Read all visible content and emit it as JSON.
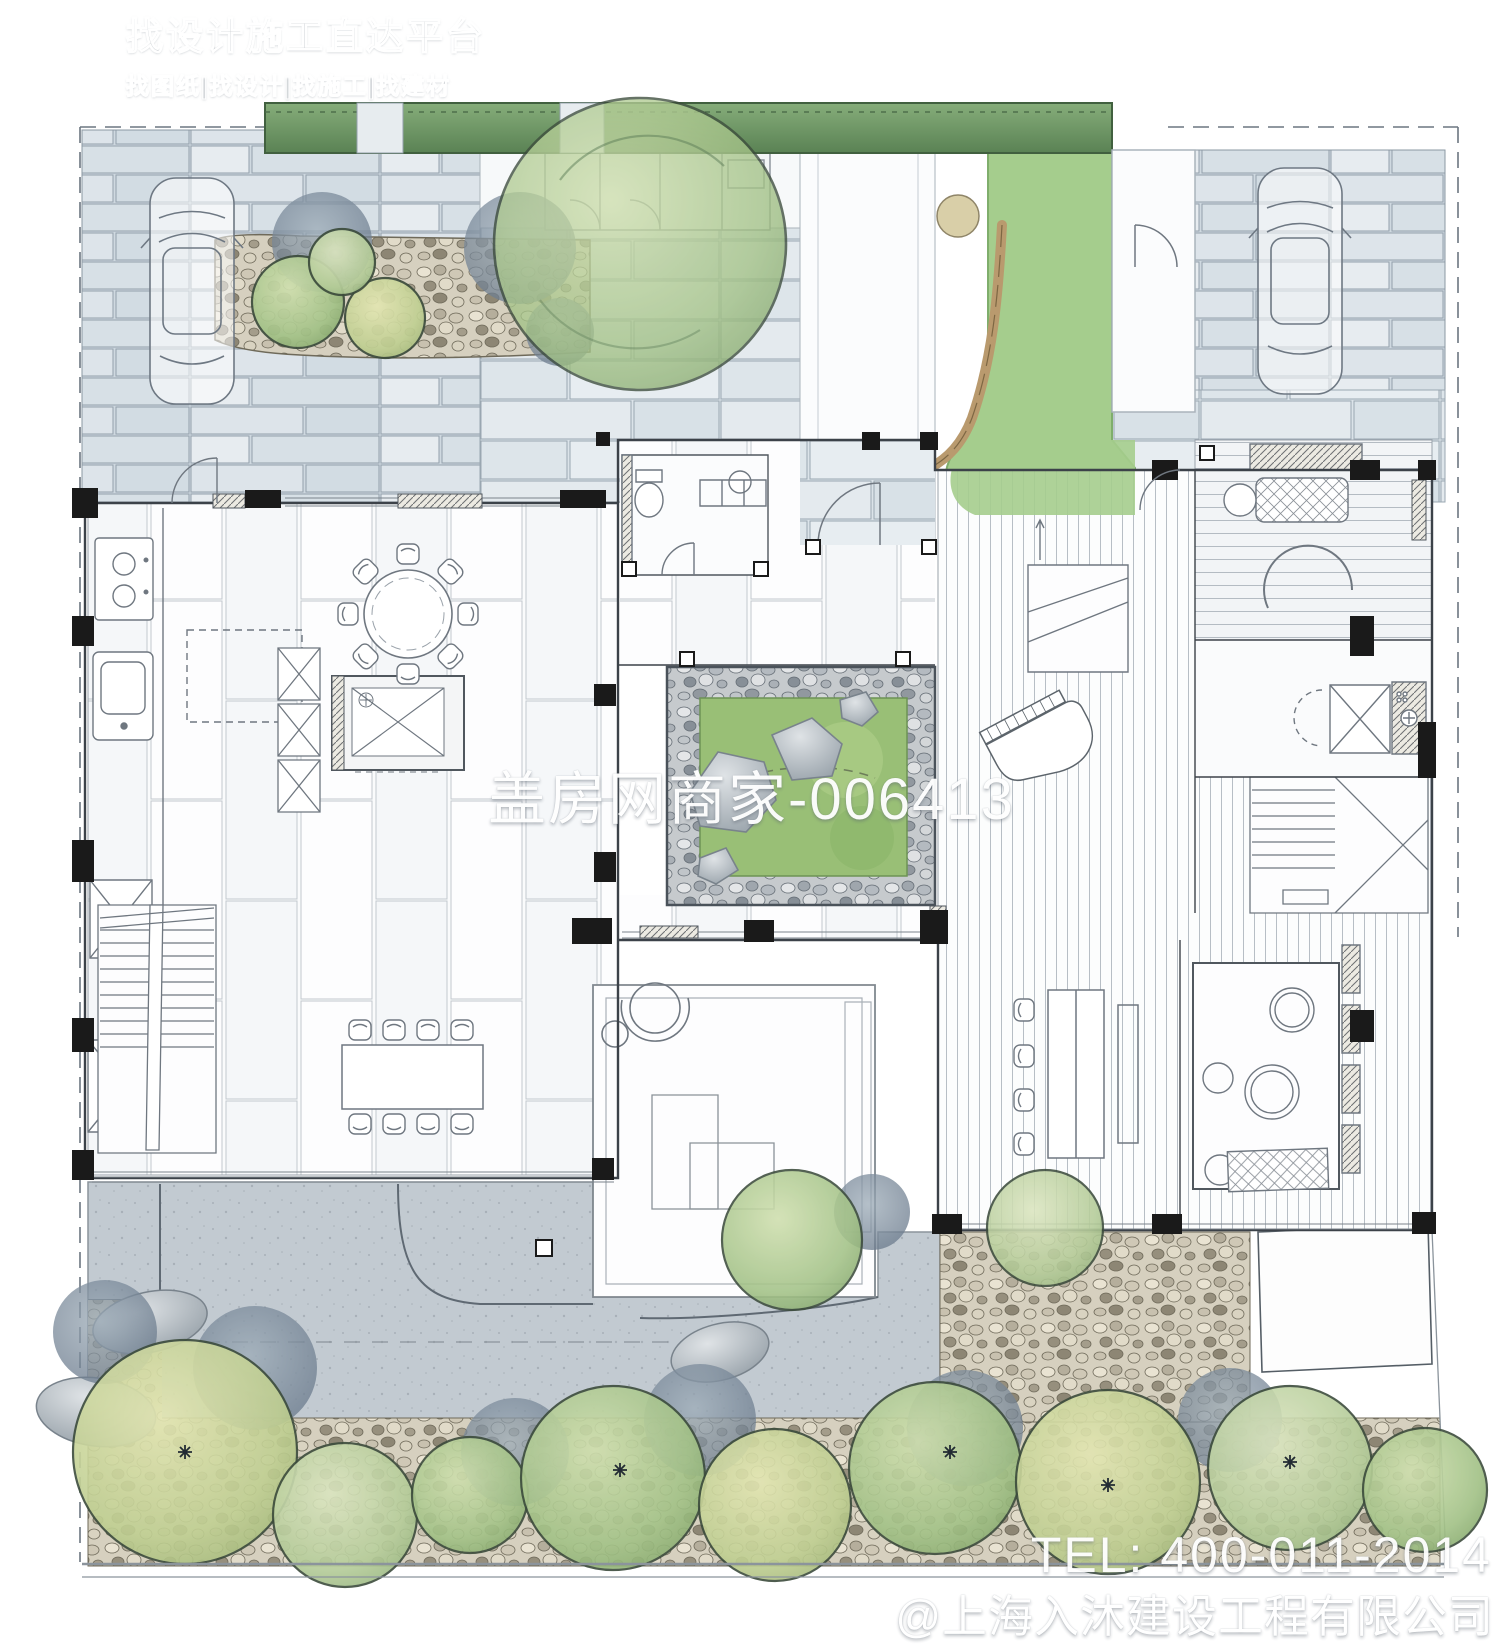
{
  "branding": {
    "logo_icon": "house-logo-icon",
    "title": "找设计施工直达平台",
    "subtitle": "找图纸|找设计|找施工|找建材"
  },
  "watermarks": {
    "center": "盖房网商家-006413",
    "phone": "TEL: 400-011-2014",
    "company": "@上海入沐建设工程有限公司"
  },
  "colors": {
    "paper": "#ffffff",
    "stone_paving": "#d5dee5",
    "stone_joint": "#93a0ab",
    "slab_light": "#e0e7ec",
    "concrete_plaza": "#c2cad1",
    "hedge_green": "#6f9a67",
    "hedge_dark": "#41603f",
    "lawn_green": "#a5cd8d",
    "curb_tan": "#b99a6e",
    "tree_green": "#9fc185",
    "tree_yellow": "#ccd89d",
    "tree_pale": "#bcd3a4",
    "shadow_slate": "#77889a",
    "pebble_sand": "#d6d0bf",
    "pebble_gray": "#c6cacd",
    "moss_green": "#99bf76",
    "rock_gray": "#b9c1c7",
    "ink_line": "#3c4249",
    "wall_black": "#1a1a1a",
    "floor_line": "#b7bec5",
    "text_white": "#ffffff"
  },
  "plan_features": [
    "site-boundary",
    "driveway-car",
    "second-car",
    "top-hedge",
    "shrub-bed",
    "entry-gatehouse",
    "large-tree-canopy",
    "lawn-strip",
    "stone-curb",
    "entry-walkway",
    "kitchen",
    "round-dining-table",
    "long-dining-table",
    "left-staircase",
    "powder-room",
    "inner-courtyard",
    "grand-piano",
    "deck-staircase",
    "tatami-room",
    "shower-room",
    "right-staircase",
    "tea-table",
    "bath-room",
    "sunken-living-platform",
    "hanging-chair",
    "terrace-plaza",
    "garden-trees",
    "white-terrace"
  ]
}
